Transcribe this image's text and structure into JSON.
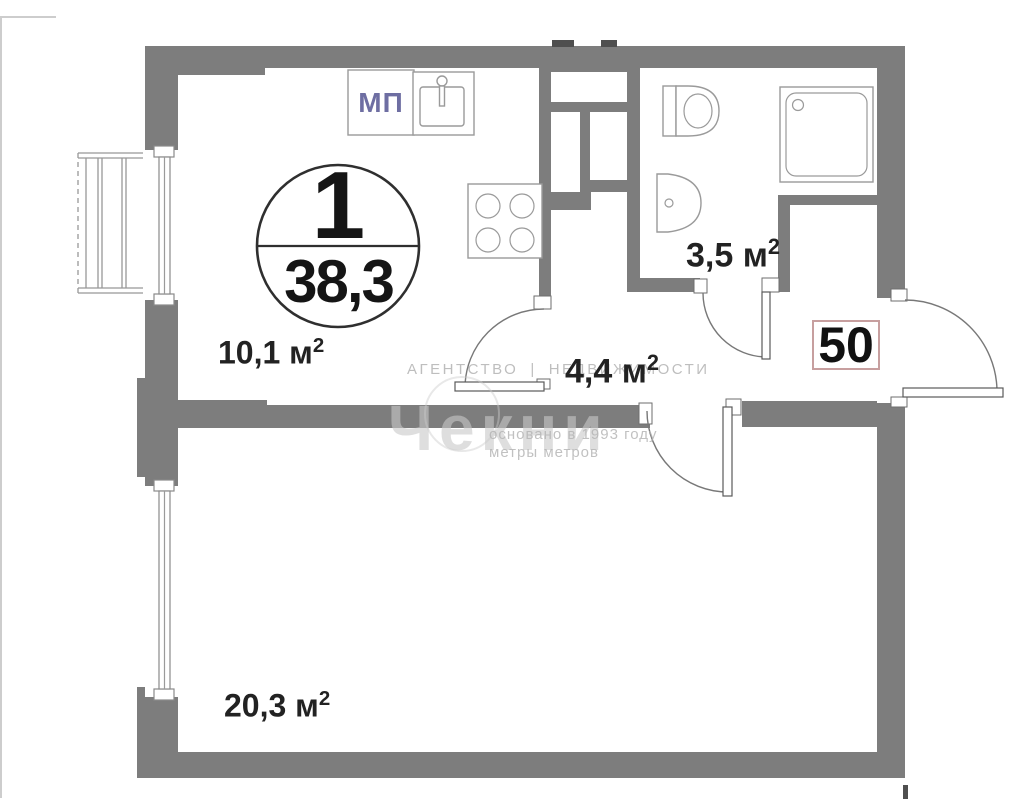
{
  "unit_circle": {
    "rooms_count": "1",
    "total_area": "38,3"
  },
  "apartment_number": "50",
  "labels": {
    "kitchen": {
      "text": "10,1 м",
      "sup": "2"
    },
    "bathroom": {
      "text": "3,5 м",
      "sup": "2"
    },
    "hallway": {
      "text": "4,4 м",
      "sup": "2"
    },
    "living": {
      "text": "20,3 м",
      "sup": "2"
    }
  },
  "markings": {
    "window_block": "МП"
  },
  "watermark": {
    "agency": "АГЕНТСТВО",
    "divider": "|",
    "realty": "НЕДВИЖИМОСТИ",
    "logo": "Чекни",
    "founded": "основано в 1993 году",
    "slogan": "метры метров"
  },
  "icons": {
    "fixtures": [
      "toilet-icon",
      "bathroom-sink-icon",
      "shower-icon",
      "kitchen-sink-icon",
      "stove-icon",
      "balcony-icon",
      "window-icon",
      "door-swing-icon"
    ]
  },
  "colors": {
    "wall": "#7d7d7d",
    "fixture-line": "#9a9a9a",
    "door-line": "#787878",
    "ink": "#222222",
    "circle-ink": "#2f2f2f",
    "apt-box-border": "#c79f9f",
    "mp-ink": "#6e6ea2",
    "dash-ink": "#4f4f4f"
  }
}
